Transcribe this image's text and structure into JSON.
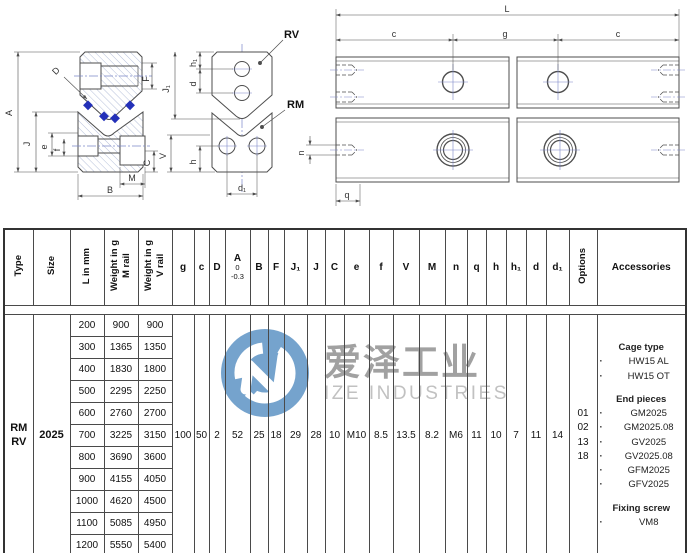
{
  "watermark": {
    "logo_cn": "爱泽工业",
    "logo_en": "IZE INDUSTRIES",
    "logo_color": "#6a9cc9"
  },
  "drawings": {
    "left": {
      "A": "A",
      "D": "D",
      "F": "F",
      "J1": "J₁",
      "J": "J",
      "e": "e",
      "f": "f",
      "V": "V",
      "C": "C",
      "M": "M",
      "B": "B"
    },
    "middle": {
      "rv": "RV",
      "rm": "RM",
      "h1": "h₁",
      "d": "d",
      "h": "h",
      "d1": "d₁"
    },
    "right": {
      "L": "L",
      "c": "c",
      "g": "g",
      "n": "n",
      "q": "q"
    }
  },
  "table": {
    "rotated_headers": {
      "type": "Type",
      "size": "Size",
      "length": "L in mm",
      "weight_m": "Weight in g\nM rail",
      "weight_v": "Weight in g\nV rail",
      "options": "Options"
    },
    "accessories_header": "Accessories",
    "dim_headers": {
      "g": "g",
      "c": "c",
      "D": "D",
      "A": "A",
      "A_tol_top": "0",
      "A_tol_bottom": "-0.3",
      "B": "B",
      "F": "F",
      "J1": "J₁",
      "J": "J",
      "C": "C",
      "e": "e",
      "f": "f",
      "V": "V",
      "M": "M",
      "n": "n",
      "q": "q",
      "h": "h",
      "h1": "h₁",
      "d": "d",
      "d1": "d₁"
    },
    "type_value": "RM\nRV",
    "size_value": "2025",
    "rows": [
      {
        "l": "200",
        "m": "900",
        "v": "900"
      },
      {
        "l": "300",
        "m": "1365",
        "v": "1350"
      },
      {
        "l": "400",
        "m": "1830",
        "v": "1800"
      },
      {
        "l": "500",
        "m": "2295",
        "v": "2250"
      },
      {
        "l": "600",
        "m": "2760",
        "v": "2700"
      },
      {
        "l": "700",
        "m": "3225",
        "v": "3150"
      },
      {
        "l": "800",
        "m": "3690",
        "v": "3600"
      },
      {
        "l": "900",
        "m": "4155",
        "v": "4050"
      },
      {
        "l": "1000",
        "m": "4620",
        "v": "4500"
      },
      {
        "l": "1100",
        "m": "5085",
        "v": "4950"
      },
      {
        "l": "1200",
        "m": "5550",
        "v": "5400"
      }
    ],
    "dim_values": {
      "g": "100",
      "c": "50",
      "D": "2",
      "A": "52",
      "B": "25",
      "F": "18",
      "J1": "29",
      "J": "28",
      "C": "10",
      "e": "M10",
      "f": "8.5",
      "V": "13.5",
      "M": "8.2",
      "n": "M6",
      "q": "11",
      "h": "10",
      "h1": "7",
      "d": "11",
      "d1": "14"
    },
    "options_values": [
      "01",
      "02",
      "13",
      "18"
    ],
    "accessories": {
      "cage_title": "Cage type",
      "cage_items": [
        "HW15 AL",
        "HW15 OT"
      ],
      "end_title": "End pieces",
      "end_items": [
        "GM2025",
        "GM2025.08",
        "GV2025",
        "GV2025.08",
        "GFM2025",
        "GFV2025"
      ],
      "fixing_title": "Fixing screw",
      "fixing_items": [
        "VM8"
      ]
    }
  }
}
